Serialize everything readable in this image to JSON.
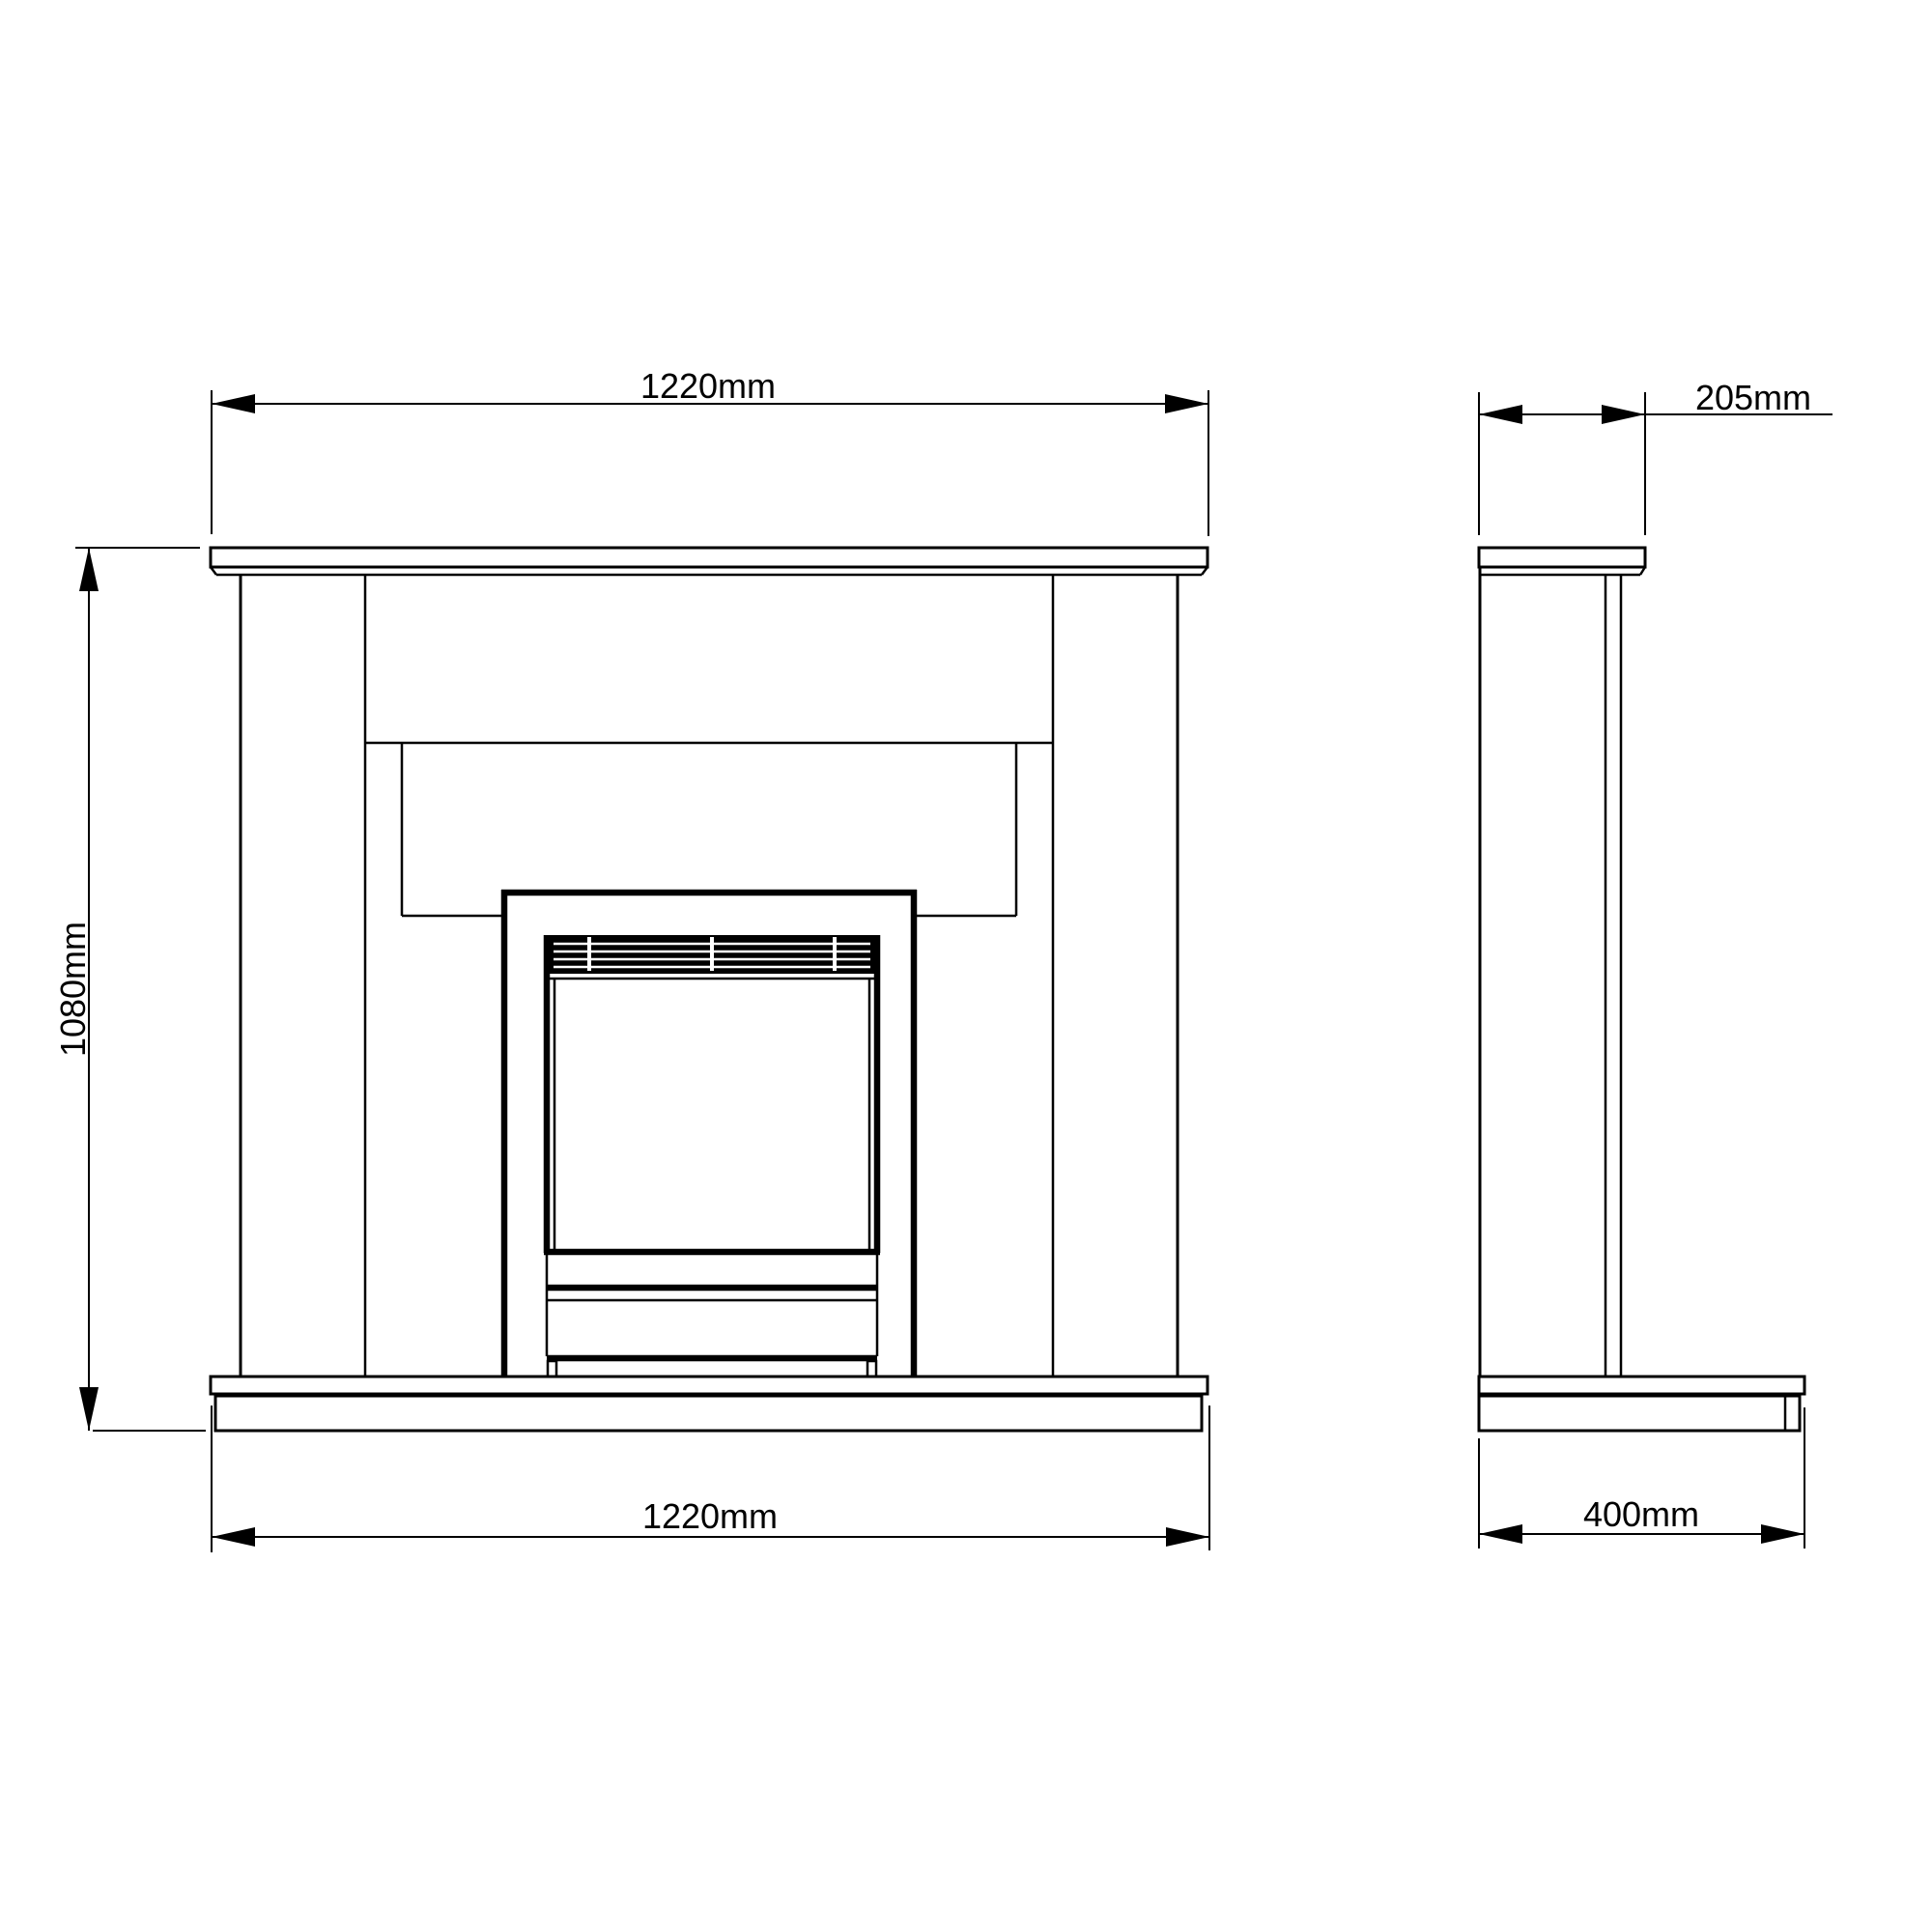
{
  "page": {
    "background_color": "#ffffff",
    "ink_color": "#000000"
  },
  "drawing": {
    "kind": "technical dimension drawing",
    "subject": "fireplace suite, front elevation and side elevation"
  },
  "dimensions": {
    "front_top_width": {
      "label": "1220mm"
    },
    "front_height": {
      "label": "1080mm"
    },
    "front_bottom_width": {
      "label": "1220mm"
    },
    "side_top_depth": {
      "label": "205mm"
    },
    "side_bottom_depth": {
      "label": "400mm"
    }
  }
}
